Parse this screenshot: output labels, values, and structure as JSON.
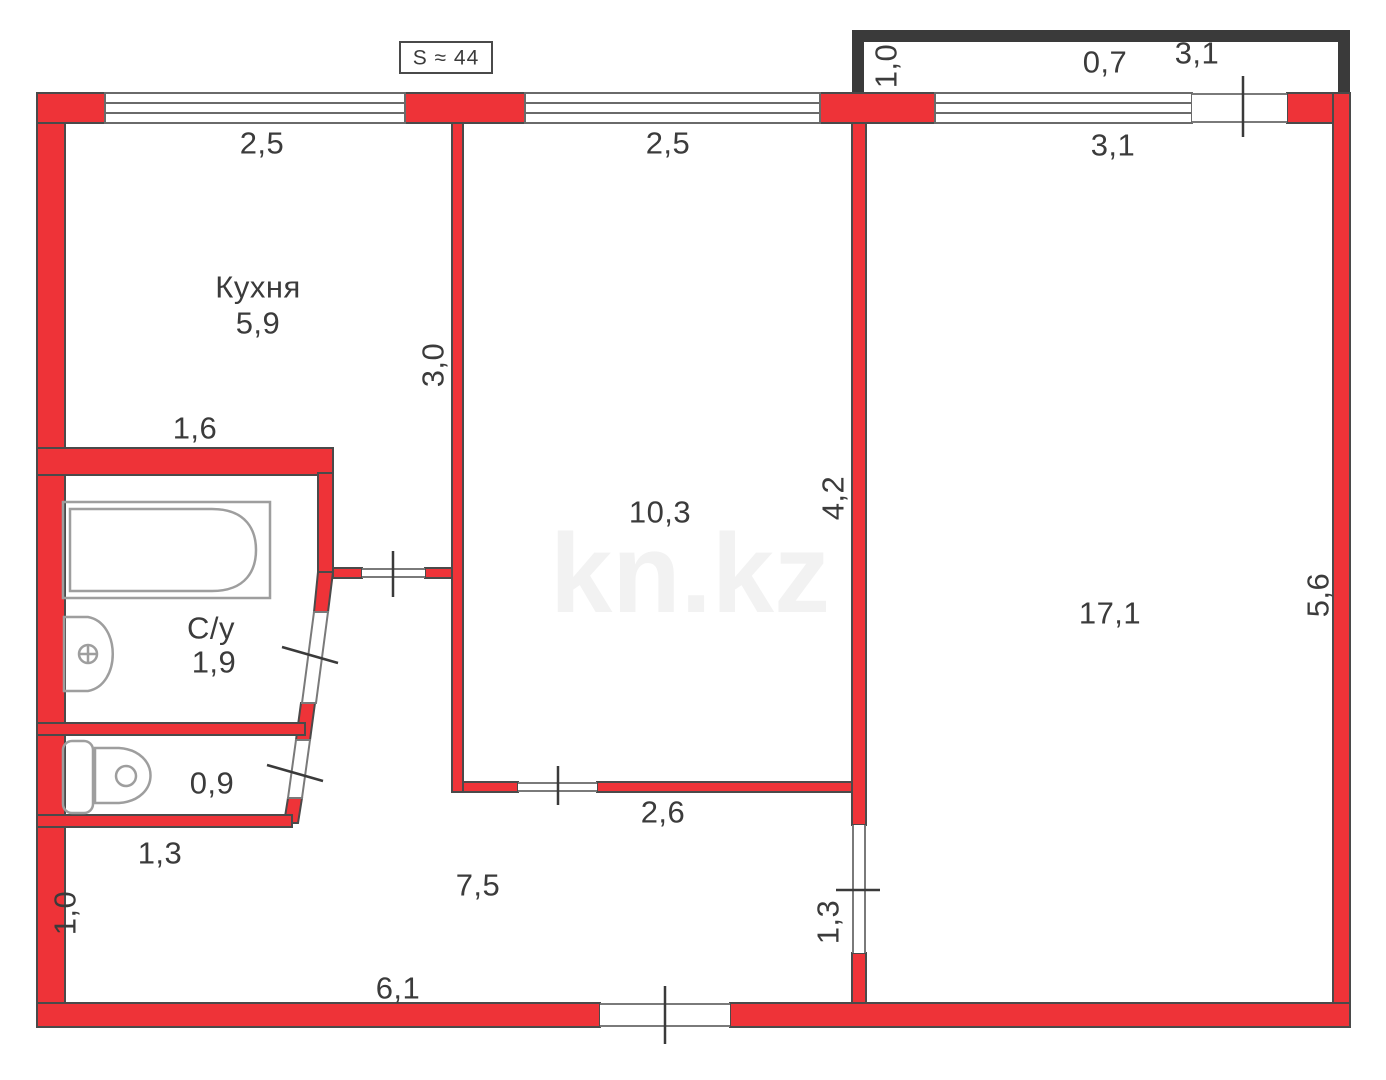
{
  "title_box": {
    "label": "S ≈ 44"
  },
  "watermark": {
    "text": "kn.kz"
  },
  "rooms": {
    "kitchen": {
      "name": "Кухня",
      "area": "5,9"
    },
    "living": {
      "area": "10,3"
    },
    "bedroom": {
      "area": "17,1"
    },
    "bathroom": {
      "name": "С/у",
      "area": "1,9"
    },
    "toilet": {
      "area": "0,9"
    },
    "hallway": {
      "area": "7,5"
    },
    "balcony": {
      "area": "0,7"
    }
  },
  "dims": {
    "kitchen_window": "2,5",
    "living_window": "2,5",
    "bedroom_window": "3,1",
    "balcony_width": "3,1",
    "balcony_depth": "1,0",
    "kitchen_height": "3,0",
    "bath_top_wall": "1,6",
    "living_height": "4,2",
    "bedroom_height": "5,6",
    "living_door_wall": "2,6",
    "toilet_wall": "1,3",
    "hall_left": "1,0",
    "hall_bottom": "6,1",
    "bedroom_door": "1,3"
  },
  "colors": {
    "wall_red": "#ee3338",
    "wall_outline": "#4a4a4a",
    "balcony_dark": "#3a3a3a",
    "window_line": "#6a6a6a",
    "tick_line": "#3a3a3a",
    "fixture_gray": "#9e9e9e",
    "label_text": "#3b3b3b",
    "watermark_gray": "#f2f2f2"
  }
}
